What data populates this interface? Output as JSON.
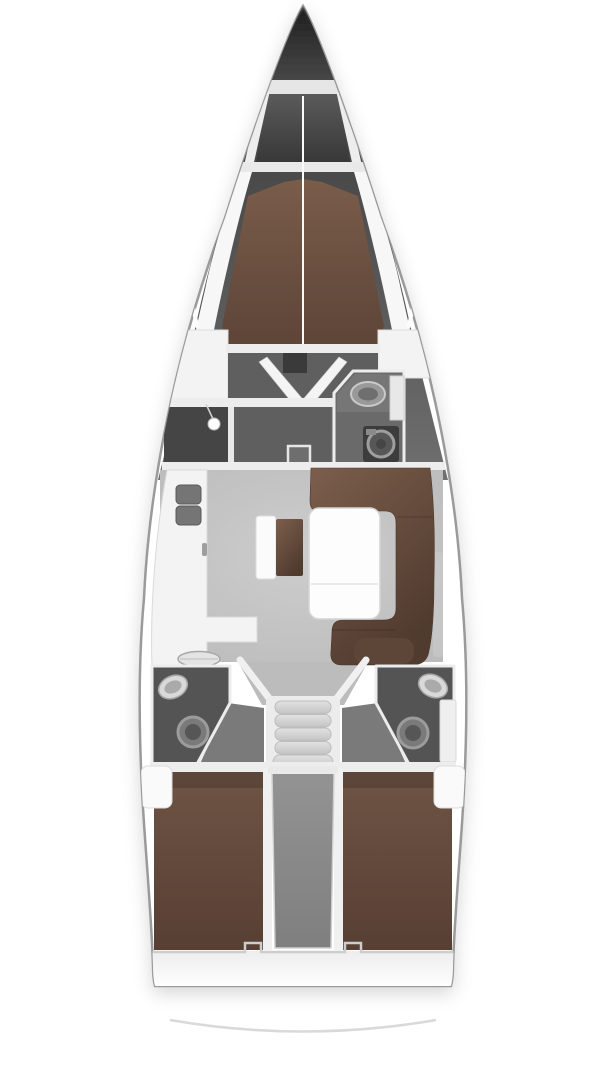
{
  "diagram": {
    "type": "sailing-yacht-interior-floor-plan",
    "view": "top-down",
    "orientation": "bow-up",
    "regions": [
      {
        "id": "anchor-locker",
        "label": "anchor locker"
      },
      {
        "id": "forward-cabin-berth",
        "label": "forward V-berth cabin"
      },
      {
        "id": "shower-room",
        "label": "separate shower compartment"
      },
      {
        "id": "forward-head",
        "label": "forward head with sink and washer"
      },
      {
        "id": "saloon",
        "label": "saloon with U-shaped sofa and table"
      },
      {
        "id": "galley",
        "label": "L-shaped galley with twin sinks and stove"
      },
      {
        "id": "companionway-stairs",
        "label": "companionway steps"
      },
      {
        "id": "port-aft-head",
        "label": "port aft head with sink and toilet"
      },
      {
        "id": "starboard-aft-head",
        "label": "starboard aft head with sink and toilet"
      },
      {
        "id": "port-aft-cabin",
        "label": "port aft double berth"
      },
      {
        "id": "starboard-aft-cabin",
        "label": "starboard aft double berth"
      },
      {
        "id": "engine-compartment",
        "label": "engine box between aft cabins"
      },
      {
        "id": "transom",
        "label": "transom with stern platform line"
      }
    ]
  },
  "colors": {
    "background": "#ffffff",
    "hull_stroke": "#9a9a9a",
    "bow_dark": "#1f1f1f",
    "hull_band": "#3f3f3f",
    "hull_band_light": "#6f6f6f",
    "deck_white": "#f7f7f7",
    "wall_white": "#ededed",
    "berth_brown": "#7a5c4a",
    "berth_brown_dark": "#5c4437",
    "aft_berth_brown": "#6f5445",
    "aft_berth_brown_dark": "#573f33",
    "sofa_brown": "#7c5e4c",
    "sofa_brown_dark": "#503b2f",
    "cabin_floor": "#5f5f5f",
    "shower_floor": "#454545",
    "head_floor": "#6a6a6a",
    "aft_head_floor": "#545454",
    "entry_floor": "#7a7a7a",
    "salon_floor": "#bcbcbc",
    "counter_white": "#f3f3f3",
    "table_white": "#fdfdfd",
    "stairs_frame": "#ececec",
    "tread_light": "#e2e2e2",
    "tread_dark": "#c4c4c4",
    "engine_gray": "#939393",
    "engine_gray_dark": "#7f7f7f",
    "fixture_light": "#d9d9d9",
    "fixture_mid": "#9a9a9a",
    "toilet_gray": "#7a7a7a",
    "locker_dark": "#3a3a3a",
    "transom_band": "#ededed",
    "stern_line": "#d9d9d9"
  }
}
